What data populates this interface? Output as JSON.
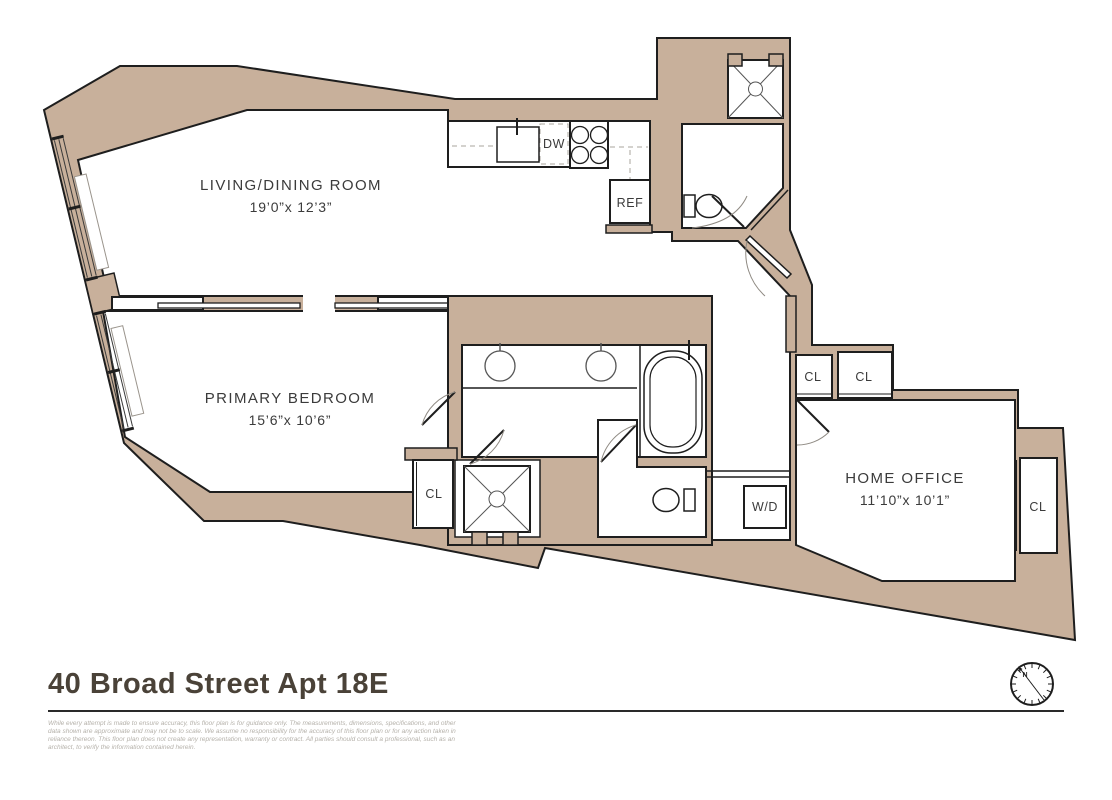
{
  "colors": {
    "wall": "#c8b09b",
    "line": "#1e1e1e",
    "muted_line": "#8f8a83",
    "title_text": "#4a4238",
    "disclaimer_text": "#b5b1aa"
  },
  "plan": {
    "rooms": [
      {
        "name": "LIVING/DINING ROOM",
        "dims": "19’0”x 12’3”"
      },
      {
        "name": "PRIMARY BEDROOM",
        "dims": "15’6”x 10’6”"
      },
      {
        "name": "HOME OFFICE",
        "dims": "11’10”x 10’1”"
      }
    ],
    "labels": {
      "dishwasher": "DW",
      "refrigerator": "REF",
      "washer_dryer": "W/D",
      "closet": "CL",
      "north": "N"
    }
  },
  "footer": {
    "title": "40 Broad Street Apt 18E",
    "disclaimer_lines": [
      "While every attempt is made to ensure accuracy, this floor plan is for guidance only. The measurements, dimensions, specifications, and other",
      "data shown are approximate and may not be to scale. We assume no responsibility for the accuracy of this floor plan or for any action taken in",
      "reliance thereon. This floor plan does not create any representation, warranty or contract. All parties should consult a professional, such as an",
      "architect, to verify the information contained herein."
    ]
  }
}
